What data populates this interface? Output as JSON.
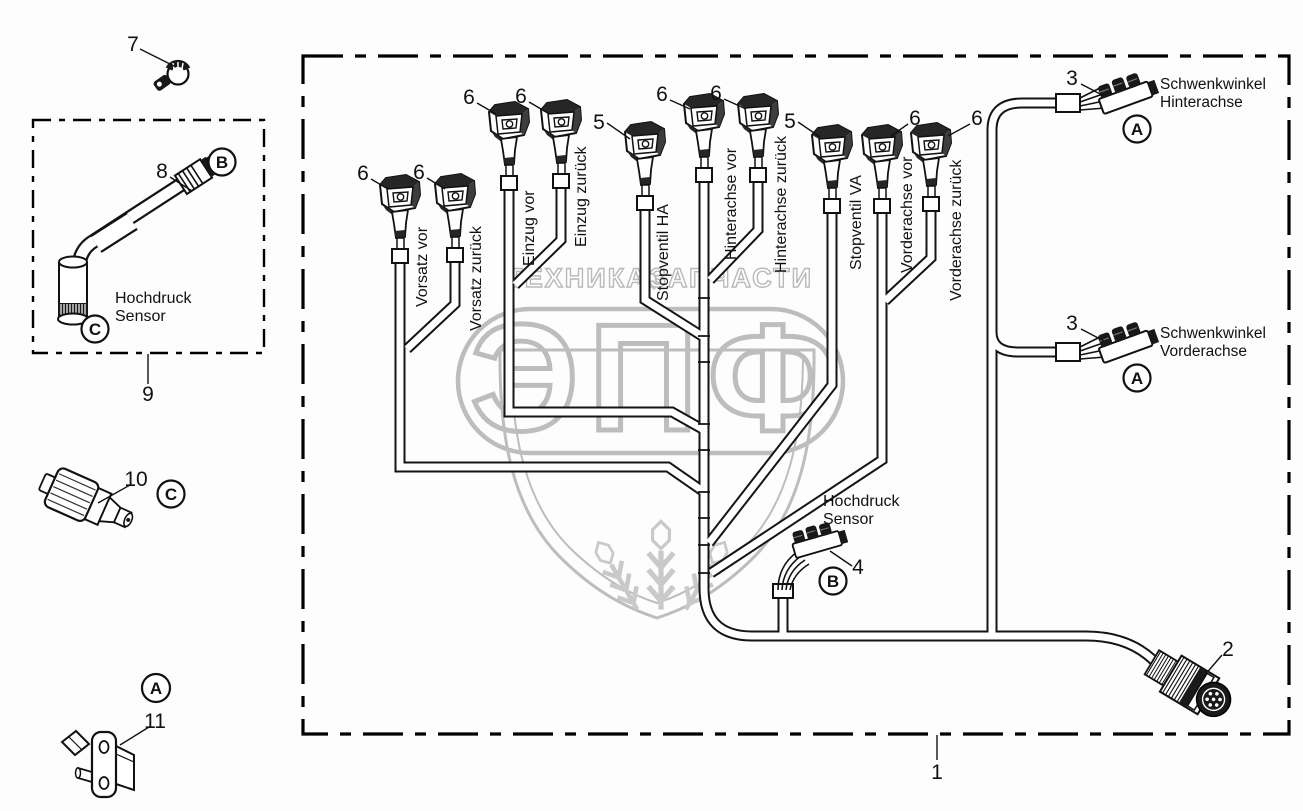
{
  "watermark": {
    "top_text_left": "ТЕХНИКА",
    "top_text_right": "ЗАПЧАСТИ",
    "gear_icon": "⚙",
    "brand_letters": "ЭПФ",
    "color": "#bdbdbd"
  },
  "main_harness": {
    "box_callout": "1",
    "round_connector_callout": "2",
    "branches": [
      {
        "callout": "6",
        "label": "Vorsatz vor"
      },
      {
        "callout": "6",
        "label": "Vorsatz zurück"
      },
      {
        "callout": "6",
        "label": "Einzug vor"
      },
      {
        "callout": "6",
        "label": "Einzug zurück"
      },
      {
        "callout": "5",
        "label": "Stopventil HA"
      },
      {
        "callout": "6",
        "label": "Hinterachse vor"
      },
      {
        "callout": "6",
        "label": "Hinterachse zurück"
      },
      {
        "callout": "5",
        "label": "Stopventil VA"
      },
      {
        "callout": "6",
        "label": "Vorderachse vor"
      },
      {
        "callout": "6",
        "label": "Vorderachse zurück"
      }
    ],
    "schwenkwinkel_hinterachse": {
      "callout": "3",
      "line1": "Schwenkwinkel",
      "line2": "Hinterachse",
      "badge": "A"
    },
    "schwenkwinkel_vorderachse": {
      "callout": "3",
      "line1": "Schwenkwinkel",
      "line2": "Vorderachse",
      "badge": "A"
    },
    "hochdruck_sensor": {
      "callout": "4",
      "line1": "Hochdruck",
      "line2": "Sensor",
      "badge": "B"
    }
  },
  "side_parts": {
    "clamp_callout": "7",
    "sensor_kit": {
      "box_callout": "9",
      "cable_callout": "8",
      "connector_badge": "B",
      "sensor_badge": "C",
      "label_line1": "Hochdruck",
      "label_line2": "Sensor"
    },
    "pressure_valve": {
      "callout": "10",
      "badge": "C"
    },
    "mount_bracket": {
      "callout": "11",
      "badge": "A"
    }
  }
}
